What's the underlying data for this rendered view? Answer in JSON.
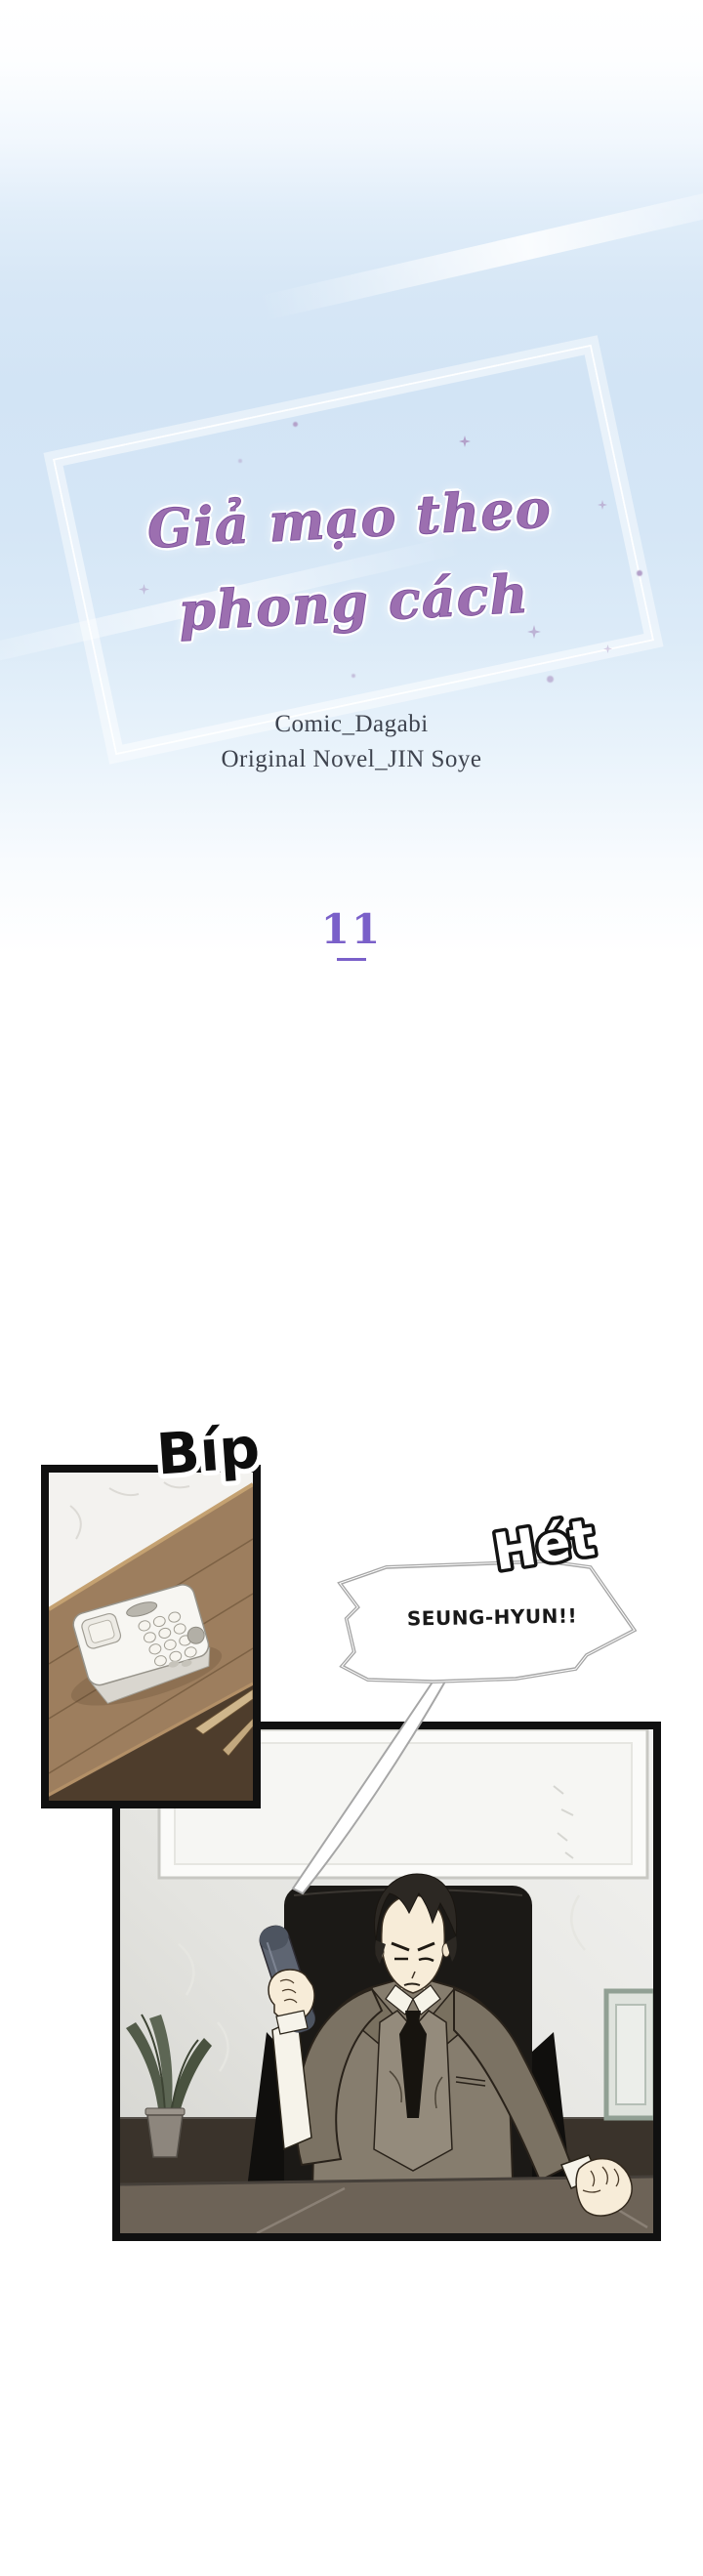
{
  "series": {
    "title_line1": "Giả mạo theo",
    "title_line2": "phong cách",
    "credit_comic": "Comic_Dagabi",
    "credit_novel": "Original Novel_JIN Soye"
  },
  "chapter": {
    "number": "11"
  },
  "sfx": {
    "phone_beep": "Bíp",
    "shout_label": "Hét"
  },
  "dialogue": {
    "shout": "SEUNG-HYUN!!"
  },
  "colors": {
    "accent_purple": "#7a60c9",
    "title_purple": "#9c6fb0",
    "sky_blue": "#d5e6f6",
    "panel_border": "#101010",
    "bubble_outline": "#a6a6a6",
    "suit_khaki": "#867d6e",
    "desk_wood": "#9d7e5e"
  }
}
